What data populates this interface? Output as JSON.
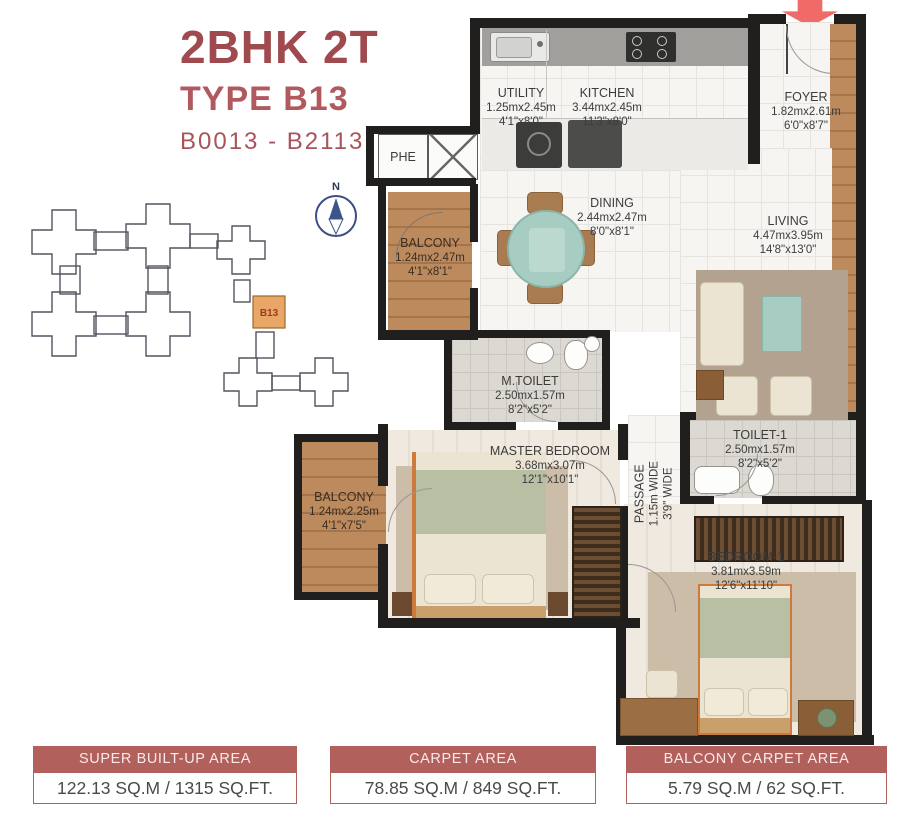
{
  "header": {
    "title": "2BHK 2T",
    "type_label": "TYPE B13",
    "unit_range": "B0013 - B2113"
  },
  "keyplan": {
    "highlight_label": "B13",
    "compass_label": "N"
  },
  "rooms": {
    "utility": {
      "name": "UTILITY",
      "metric": "1.25mx2.45m",
      "imperial": "4'1\"x8'0\""
    },
    "kitchen": {
      "name": "KITCHEN",
      "metric": "3.44mx2.45m",
      "imperial": "11'3\"x8'0\""
    },
    "foyer": {
      "name": "FOYER",
      "metric": "1.82mx2.61m",
      "imperial": "6'0\"x8'7\""
    },
    "balcony_top": {
      "name": "BALCONY",
      "metric": "1.24mx2.47m",
      "imperial": "4'1\"x8'1\""
    },
    "dining": {
      "name": "DINING",
      "metric": "2.44mx2.47m",
      "imperial": "8'0\"x8'1\""
    },
    "living": {
      "name": "LIVING",
      "metric": "4.47mx3.95m",
      "imperial": "14'8\"x13'0\""
    },
    "m_toilet": {
      "name": "M.TOILET",
      "metric": "2.50mx1.57m",
      "imperial": "8'2\"x5'2\""
    },
    "master_bedroom": {
      "name": "MASTER BEDROOM",
      "metric": "3.68mx3.07m",
      "imperial": "12'1\"x10'1\""
    },
    "balcony_mid": {
      "name": "BALCONY",
      "metric": "1.24mx2.25m",
      "imperial": "4'1\"x7'5\""
    },
    "passage": {
      "name": "PASSAGE",
      "metric": "1.15m WIDE",
      "imperial": "3'9\" WIDE"
    },
    "toilet_1": {
      "name": "TOILET-1",
      "metric": "2.50mx1.57m",
      "imperial": "8'2\"x5'2\""
    },
    "bedroom_1": {
      "name": "BEDROOM-1",
      "metric": "3.81mx3.59m",
      "imperial": "12'6\"x11'10\""
    },
    "phe": {
      "name": "PHE"
    }
  },
  "stats": [
    {
      "label": "SUPER BUILT-UP AREA",
      "value": "122.13 SQ.M / 1315 SQ.FT."
    },
    {
      "label": "CARPET AREA",
      "value": "78.85 SQ.M / 849 SQ.FT."
    },
    {
      "label": "BALCONY CARPET AREA",
      "value": "5.79 SQ.M / 62 SQ.FT."
    }
  ],
  "colors": {
    "accent": "#b2605c",
    "title_dark": "#9f4a4e",
    "title_light": "#b05a60",
    "wall": "#211f1e",
    "wood": "#b0805a",
    "teal": "#a7cdc3",
    "keyplan_highlight": "#e8a766",
    "entrance_arrow": "#f06a68"
  }
}
